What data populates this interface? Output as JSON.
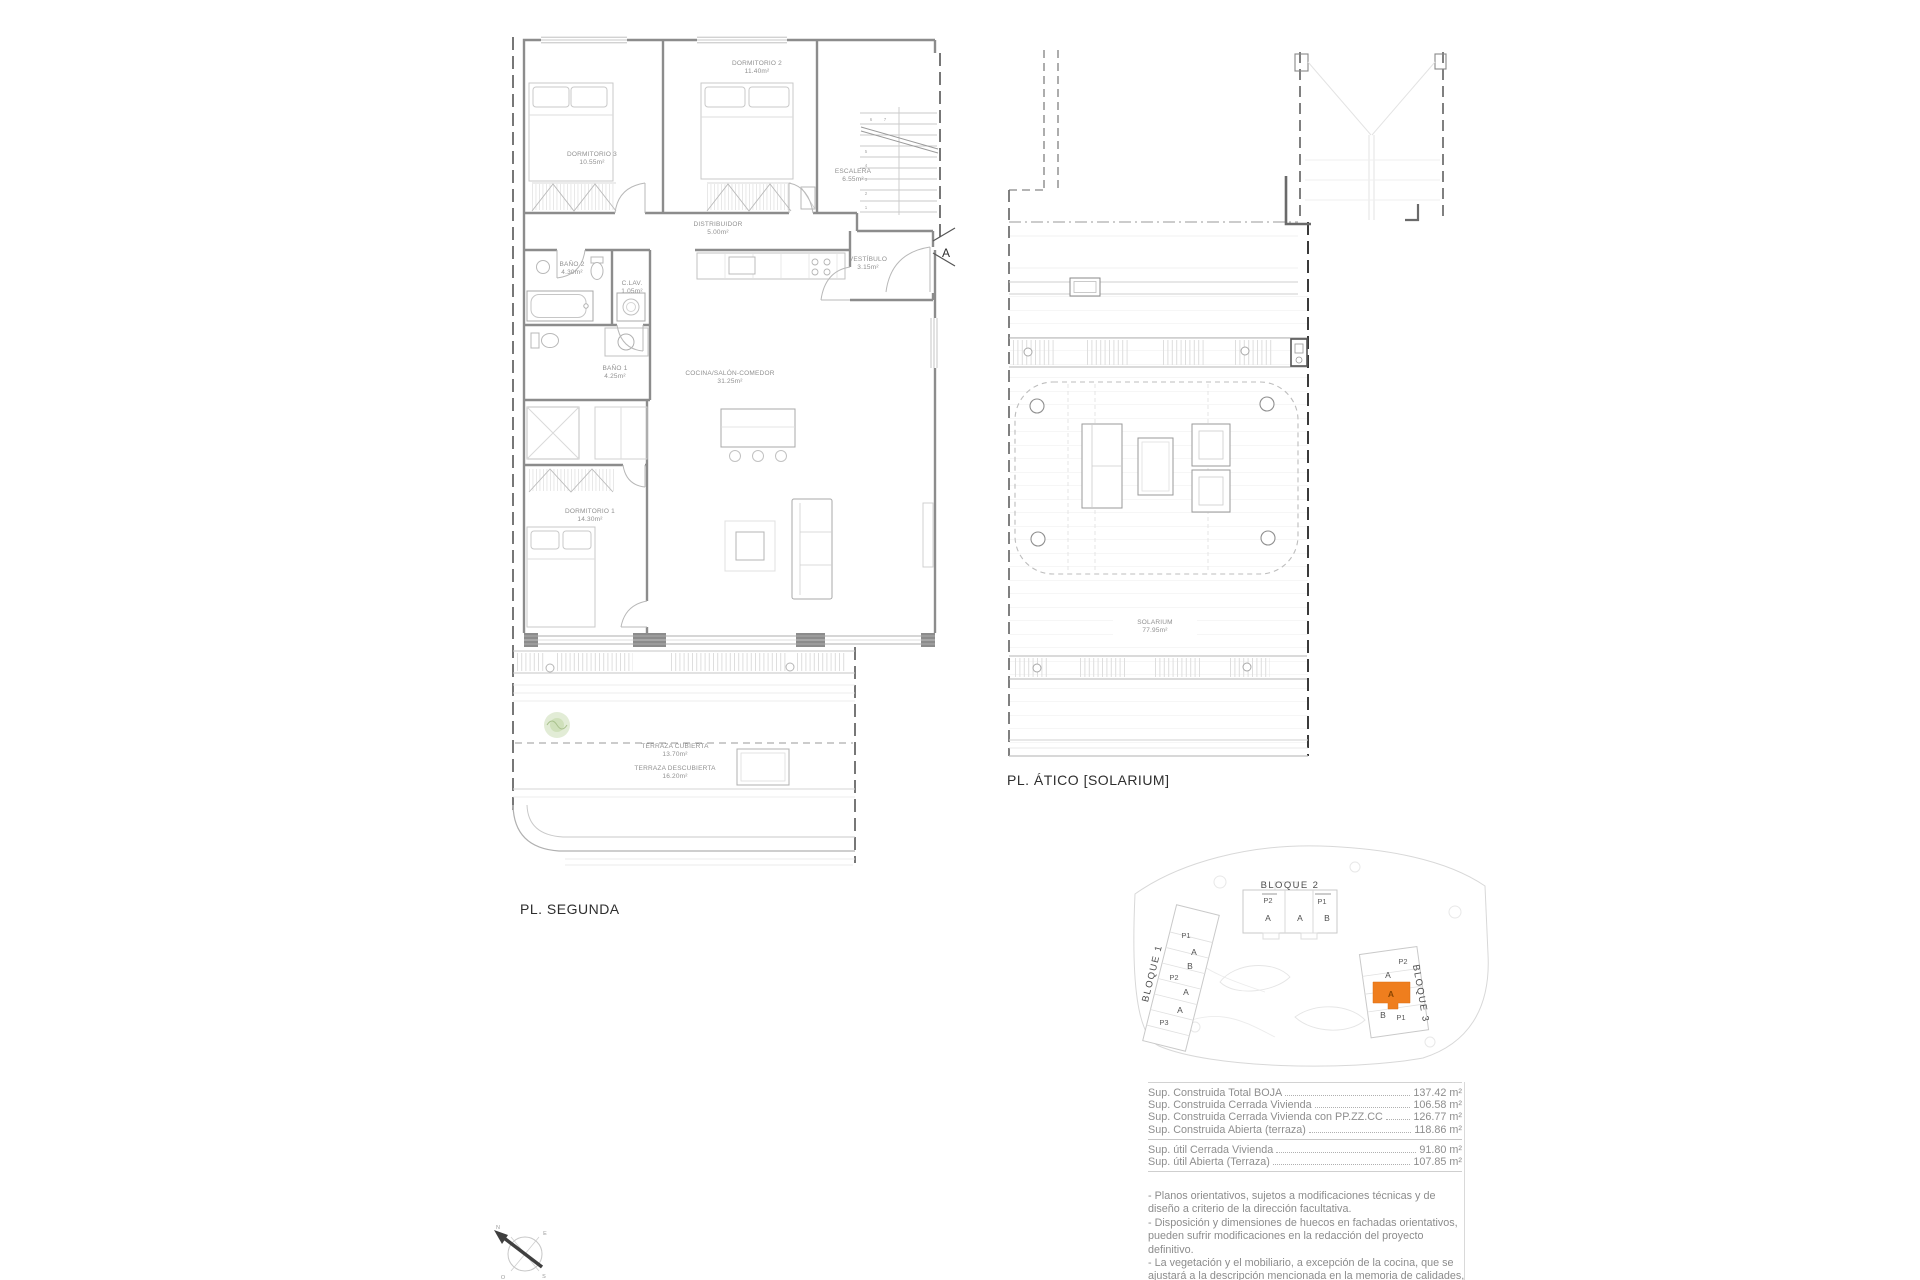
{
  "plan_segunda": {
    "title": "PL. SEGUNDA",
    "entrance_marker": "A",
    "rooms": {
      "dormitorio3": {
        "name": "DORMITORIO 3",
        "area": "10.55m²"
      },
      "dormitorio2": {
        "name": "DORMITORIO 2",
        "area": "11.40m²"
      },
      "escalera": {
        "name": "ESCALERA",
        "area": "6.55m²"
      },
      "distribuidor": {
        "name": "DISTRIBUIDOR",
        "area": "5.00m²"
      },
      "vestibulo": {
        "name": "VESTÍBULO",
        "area": "3.15m²"
      },
      "bano2": {
        "name": "BAÑO 2",
        "area": "4.30m²"
      },
      "clav": {
        "name": "C.LAV.",
        "area": "1.05m²"
      },
      "bano1": {
        "name": "BAÑO 1",
        "area": "4.25m²"
      },
      "cocina_salon": {
        "name": "COCINA/SALÓN-COMEDOR",
        "area": "31.25m²"
      },
      "dormitorio1": {
        "name": "DORMITORIO 1",
        "area": "14.30m²"
      },
      "terraza_cubierta": {
        "name": "TERRAZA CUBIERTA",
        "area": "13.70m²"
      },
      "terraza_descubierta": {
        "name": "TERRAZA DESCUBIERTA",
        "area": "16.20m²"
      }
    },
    "stair_numbers": [
      "1",
      "2",
      "3",
      "4",
      "5",
      "6",
      "7"
    ]
  },
  "plan_atico": {
    "title": "PL. ÁTICO [SOLARIUM]",
    "rooms": {
      "solarium": {
        "name": "SOLARIUM",
        "area": "77.95m²"
      }
    }
  },
  "site_plan": {
    "bloque1": {
      "label": "BLOQUE 1",
      "units": [
        "P1",
        "A",
        "B",
        "P2",
        "A",
        "A",
        "P3"
      ]
    },
    "bloque2": {
      "label": "BLOQUE 2",
      "units": [
        "P2",
        "P1",
        "A",
        "A",
        "B"
      ]
    },
    "bloque3": {
      "label": "BLOQUE 3",
      "units": [
        "P2",
        "A",
        "A",
        "B",
        "P1"
      ],
      "highlighted_unit": "A",
      "highlight_color": "#EF7E1E"
    }
  },
  "areas_table": {
    "rows": [
      {
        "label": "Sup. Construida Total BOJA",
        "value": "137.42 m²"
      },
      {
        "label": "Sup. Construida Cerrada Vivienda",
        "value": "106.58 m²"
      },
      {
        "label": "Sup. Construida Cerrada Vivienda con PP.ZZ.CC",
        "value": "126.77 m²"
      },
      {
        "label": "Sup. Construida Abierta (terraza)",
        "value": "118.86 m²"
      },
      {
        "label": "Sup. útil Cerrada Vivienda",
        "value": "91.80 m²"
      },
      {
        "label": "Sup. útil Abierta (Terraza)",
        "value": "107.85 m²"
      }
    ]
  },
  "notes": [
    "- Planos orientativos, sujetos a modificaciones técnicas y de diseño a criterio de la dirección facultativa.",
    "- Disposición y dimensiones de huecos en fachadas orientativos, pueden sufrir modificaciones en la redacción del proyecto definitivo.",
    "- La vegetación y el mobiliario, a excepción de la cocina, que se ajustará a la descripción mencionada en la memoria de calidades, tienen carácter exclusivamente estético, no siendo en ningún caso objeto de compraventa."
  ]
}
